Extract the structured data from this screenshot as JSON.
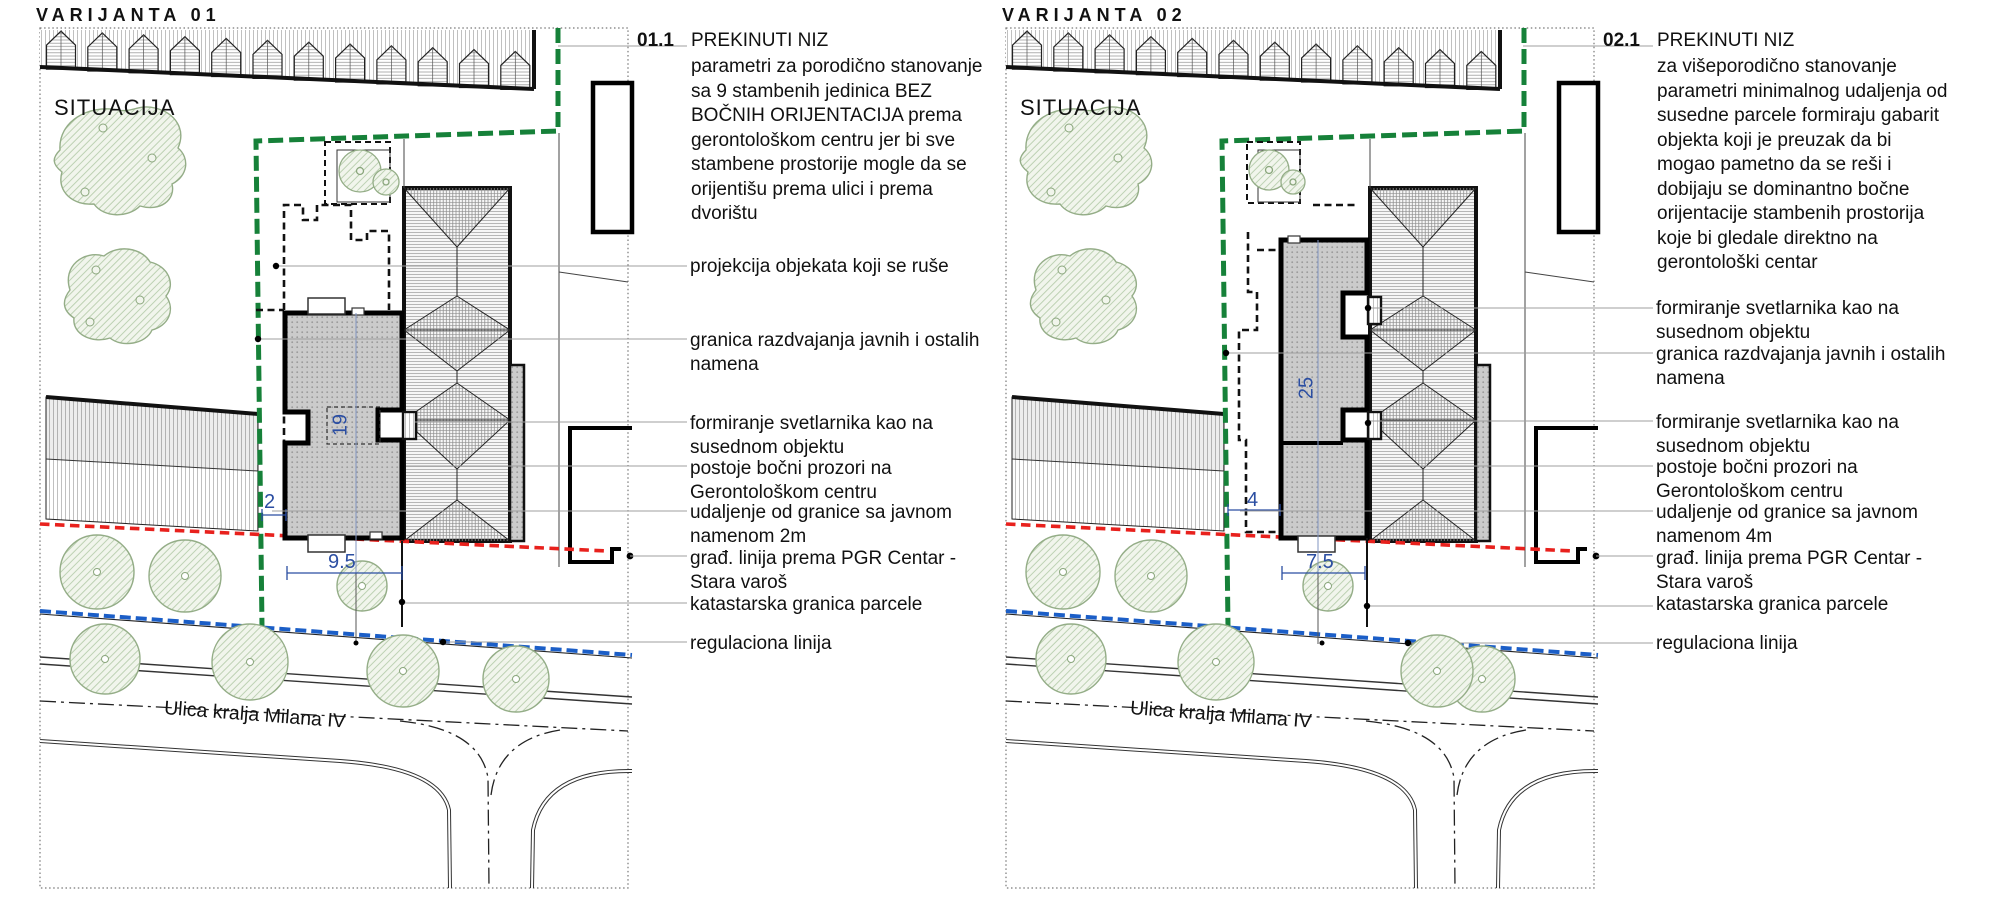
{
  "colors": {
    "boundary_green": "#168139",
    "building_line_red": "#E8211D",
    "regulation_blue": "#1B5EC7",
    "dimension_blue": "#2B4EA2",
    "new_building_gray": "#CBCBCB"
  },
  "panels": [
    {
      "title": "VARIJANTA 01",
      "plan_label": "SITUACIJA",
      "street_label": "Ulica kralja Milana IV",
      "note": {
        "ref": "01.1",
        "heading": "PREKINUTI NIZ",
        "body": "parametri za porodično stanovanje sa 9 stambenih jedinica BEZ BOČNIH ORIJENTACIJA prema gerontološkom centru jer bi sve stambene prostorije mogle da se orijentišu prema ulici i prema dvorištu"
      },
      "dimensions": {
        "building_depth": "19",
        "side_setback": "2",
        "building_width": "9.5"
      },
      "callouts": [
        {
          "text": "projekcija objekata koji se ruše"
        },
        {
          "text": "granica razdvajanja javnih i ostalih namena"
        },
        {
          "text": "formiranje svetlarnika kao na susednom objektu"
        },
        {
          "text": "postoje bočni prozori na Gerontološkom centru"
        },
        {
          "text": "udaljenje od granice sa javnom namenom 2m"
        },
        {
          "text": "građ. linija prema PGR Centar - Stara varoš"
        },
        {
          "text": "katastarska granica parcele"
        },
        {
          "text": "regulaciona linija"
        }
      ]
    },
    {
      "title": "VARIJANTA 02",
      "plan_label": "SITUACIJA",
      "street_label": "Ulica kralja Milana IV",
      "note": {
        "ref": "02.1",
        "heading": "PREKINUTI NIZ",
        "body": "za višeporodično stanovanje parametri minimalnog udaljenja od susedne parcele formiraju gabarit objekta koji je preuzak da bi mogao pametno da se reši i dobijaju se dominantno bočne orijentacije stambenih prostorija koje bi gledale direktno na gerontološki centar"
      },
      "dimensions": {
        "building_depth": "25",
        "side_setback": "4",
        "building_width": "7.5"
      },
      "callouts": [
        {
          "text": "formiranje svetlarnika kao na susednom objektu"
        },
        {
          "text": "granica razdvajanja javnih i ostalih namena"
        },
        {
          "text": "formiranje svetlarnika kao na susednom objektu"
        },
        {
          "text": "postoje bočni prozori na Gerontološkom centru"
        },
        {
          "text": "udaljenje od granice sa javnom namenom 4m"
        },
        {
          "text": "građ. linija prema PGR Centar - Stara varoš"
        },
        {
          "text": "katastarska granica parcele"
        },
        {
          "text": "regulaciona linija"
        }
      ]
    }
  ]
}
